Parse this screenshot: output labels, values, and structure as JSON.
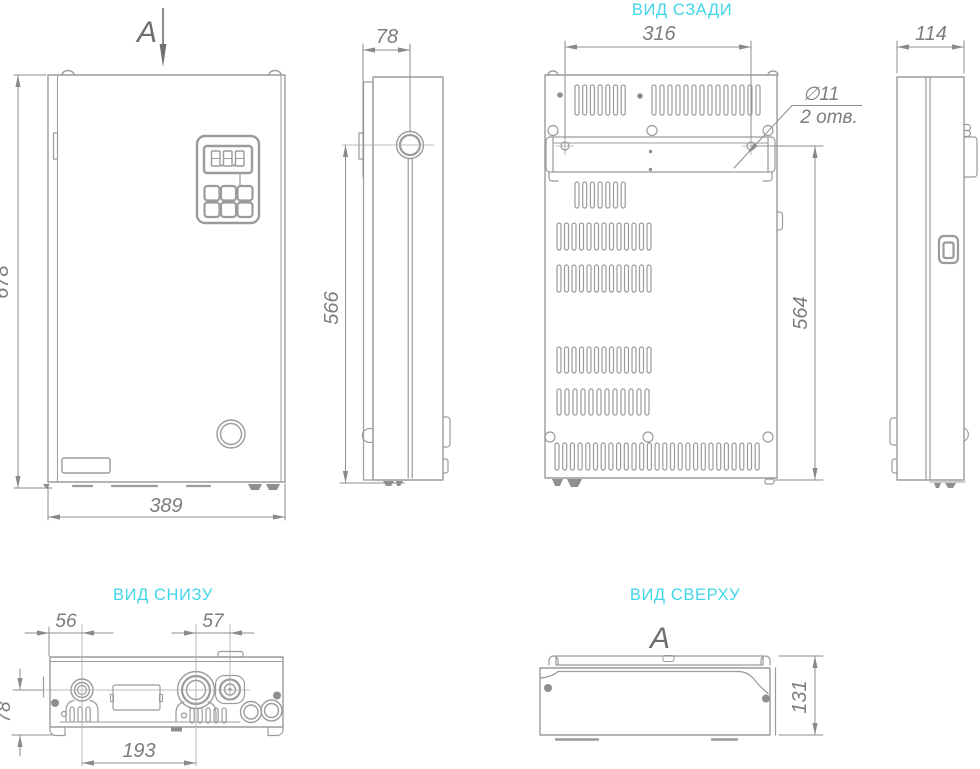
{
  "colors": {
    "line": "#9b9b9b",
    "accent_cyan": "#41d6e8",
    "dim_text": "#7d7d7d",
    "section_dark": "#6f6f6f"
  },
  "views": {
    "front": {
      "section_label": "A",
      "dims": {
        "height": "678",
        "width": "389"
      }
    },
    "side_left": {
      "dims": {
        "front_to_pipe": "78",
        "pipe_to_floor": "566"
      }
    },
    "rear": {
      "title": "ВИД СЗАДИ",
      "dims": {
        "top_holes_span": "316",
        "bracket_to_floor": "564"
      },
      "note": {
        "diameter": "∅11",
        "count": "2 отв."
      }
    },
    "side_right": {
      "dims": {
        "depth": "114"
      }
    },
    "bottom": {
      "title": "ВИД СНИЗУ",
      "dims": {
        "edge_to_pipe": "56",
        "big_to_small": "57",
        "face_to_axis": "78",
        "pipes_span": "193"
      }
    },
    "top": {
      "title": "ВИД СВЕРХУ",
      "section_label": "A",
      "dims": {
        "depth": "131"
      }
    }
  }
}
